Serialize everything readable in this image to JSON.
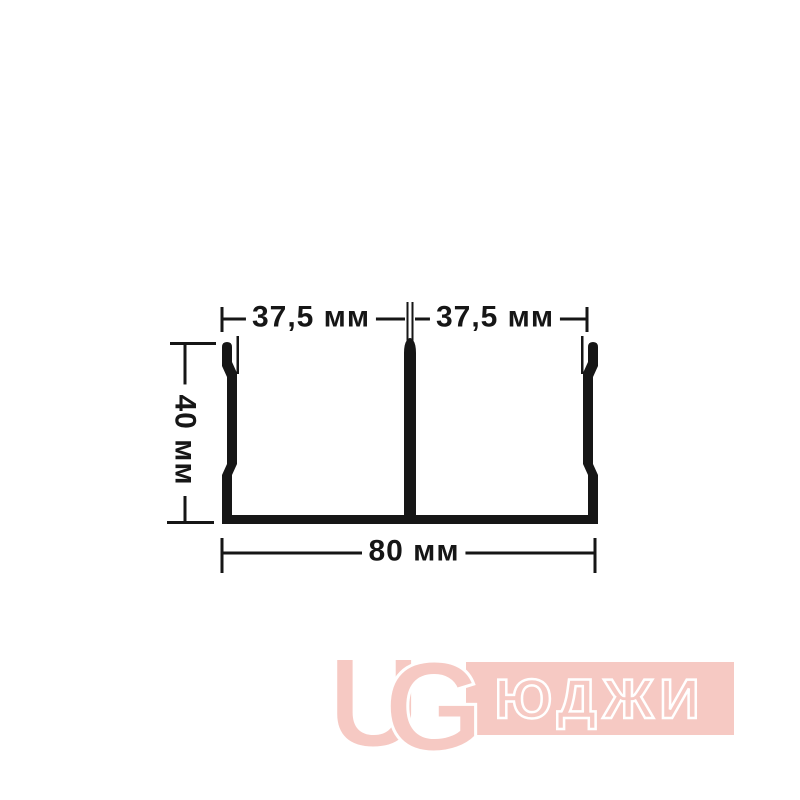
{
  "drawing": {
    "type": "profile-cross-section",
    "dimensions": {
      "top_left": "37,5 мм",
      "top_right": "37,5 мм",
      "left": "40 мм",
      "bottom": "80 мм"
    },
    "line_color": "#161616"
  },
  "watermark": {
    "letter_u": "U",
    "letter_g": "G",
    "brand_text": "ЮДЖИ",
    "color": "#f6c9c3"
  }
}
